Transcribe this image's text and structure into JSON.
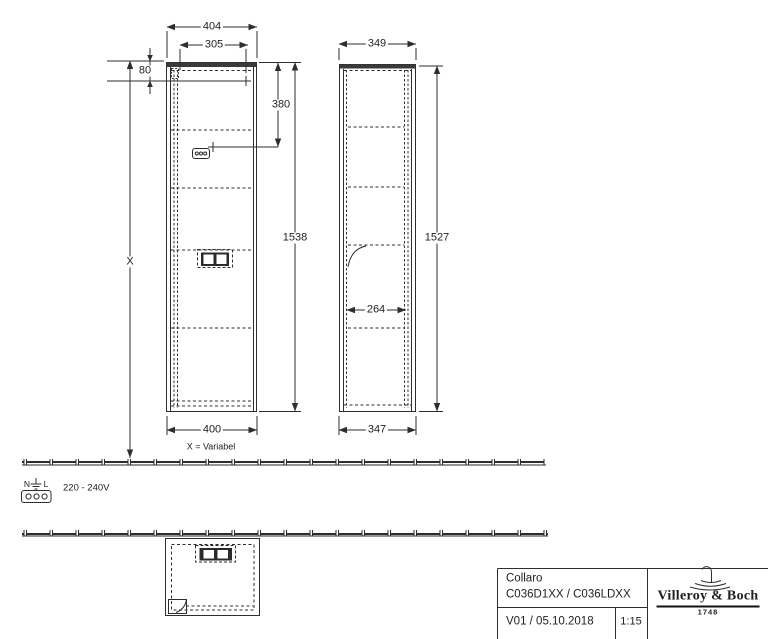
{
  "front_view": {
    "dim_width_top": "404",
    "dim_mount_width": "305",
    "dim_mount_offset": "80",
    "dim_top_section": "380",
    "dim_height": "1538",
    "dim_width_bottom": "400",
    "dim_floor_clearance": "X",
    "variable_note": "X = Variabel"
  },
  "side_view": {
    "dim_depth_top": "349",
    "dim_height": "1527",
    "dim_inner_depth": "264",
    "dim_depth_bottom": "347"
  },
  "electrical": {
    "terminal_neutral": "N",
    "terminal_line": "L",
    "voltage": "220 - 240V"
  },
  "title_block": {
    "product_name": "Collaro",
    "product_codes": "C036D1XX / C036LDXX",
    "version_date": "V01 / 05.10.2018",
    "scale": "1:15",
    "brand": "Villeroy & Boch",
    "brand_year": "1748"
  },
  "icons": {
    "ground": "earth-ground",
    "power_connector": "three-pin-connector",
    "power_socket": "double-socket",
    "mount_point": "cross-marker",
    "brand_mark": "fountain"
  },
  "colors": {
    "line": "#2e2e2e",
    "text": "#1f1f1f",
    "background": "#ffffff"
  }
}
